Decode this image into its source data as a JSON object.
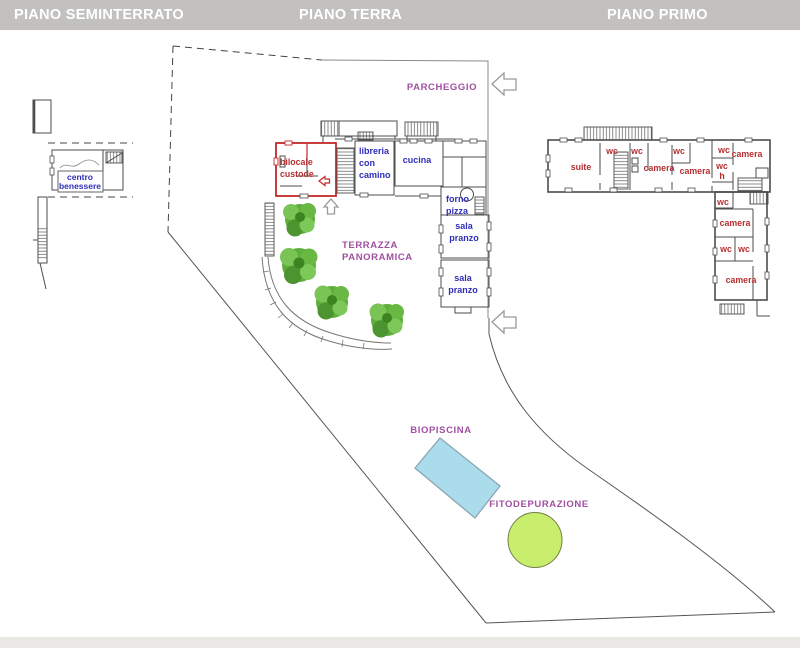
{
  "header": {
    "titles": [
      "PIANO SEMINTERRATO",
      "PIANO TERRA",
      "PIANO PRIMO"
    ],
    "bg_color": "#c2c1c0",
    "text_color": "#ffffff"
  },
  "colors": {
    "blue_room_label": "#2e2eb8",
    "red_room_label": "#b53030",
    "purple_site_label": "#a14fa1",
    "red_outline": "#c22a2a",
    "plan_line": "#4d4d4d",
    "pool_fill": "#abdcec",
    "pool_stroke": "#8aa6b4",
    "pond_fill": "#c9ee6e",
    "pond_stroke": "#6f8040",
    "tree_green": "#5fae3c"
  },
  "seminterrato": {
    "room_label": [
      "centro",
      "benessere"
    ]
  },
  "terra": {
    "bilocale": [
      "bilocale",
      "custode"
    ],
    "libreria": [
      "libreria",
      "con",
      "camino"
    ],
    "cucina": "cucina",
    "forno_pizza": [
      "forno",
      "pizza"
    ],
    "sala_pranzo_1": [
      "sala",
      "pranzo"
    ],
    "sala_pranzo_2": [
      "sala",
      "pranzo"
    ]
  },
  "primo": {
    "suite": "suite",
    "wc_top_1": "wc",
    "wc_top_2": "wc",
    "wc_top_3": "wc",
    "wc_top_4": "wc",
    "camera_1": "camera",
    "camera_2": "camera",
    "camera_3": "camera",
    "wc_h": [
      "wc",
      "h"
    ],
    "wc_mid": "wc",
    "camera_4": "camera",
    "wc_low_1": "wc",
    "wc_low_2": "wc",
    "camera_5": "camera"
  },
  "site": {
    "parcheggio": "PARCHEGGIO",
    "terrazza": [
      "TERRAZZA",
      "PANORAMICA"
    ],
    "biopiscina": "BIOPISCINA",
    "fitodepurazione": "FITODEPURAZIONE"
  }
}
